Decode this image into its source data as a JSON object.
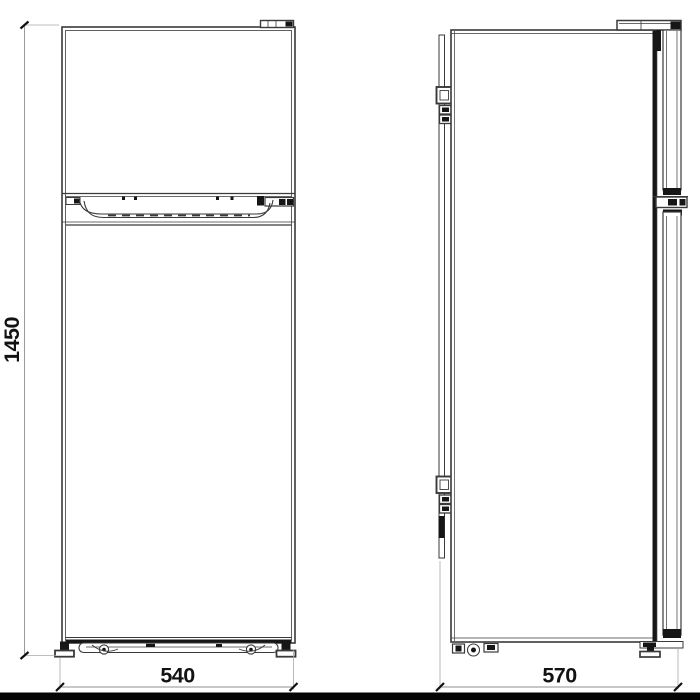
{
  "drawing": {
    "subject": "refrigerator-dimension-drawing",
    "height_label": "1450",
    "width_label": "540",
    "depth_label": "570"
  },
  "colors": {
    "background": "#ffffff",
    "line": "#3a3a3a",
    "dark_detail": "#161616",
    "dimension_line": "#8f8f8f",
    "label_text": "#121212",
    "footer_bar": "#060606"
  }
}
